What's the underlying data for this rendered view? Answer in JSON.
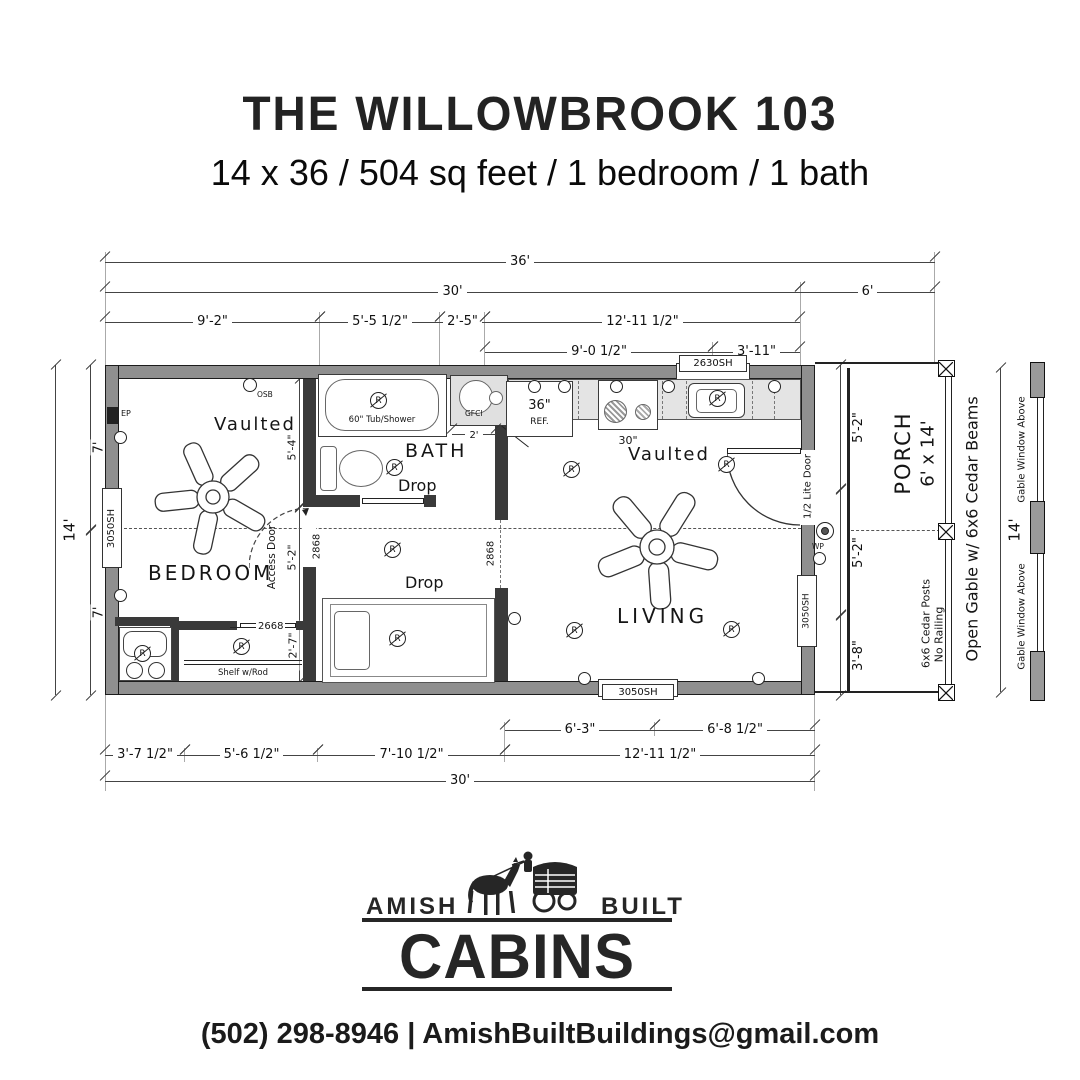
{
  "header": {
    "title": "THE WILLOWBROOK 103",
    "subtitle": "14 x 36 / 504 sq feet / 1 bedroom / 1 bath"
  },
  "rooms": {
    "bedroom": "BEDROOM",
    "bath": "BATH",
    "living": "LIVING",
    "porch": "PORCH",
    "porch_size": "6' x 14'",
    "vaulted_bedroom": "Vaulted",
    "vaulted_living": "Vaulted",
    "drop_bath": "Drop",
    "drop_hall": "Drop"
  },
  "fixtures": {
    "tub": "60\" Tub/Shower",
    "fridge_width": "36\"",
    "fridge": "REF.",
    "range_width": "30\"",
    "gfci": "GFCI",
    "shelf": "Shelf w/Rod",
    "receptacle": "R"
  },
  "notes": {
    "access_door": "Access Door",
    "half_lite_door": "1/2 Lite Door",
    "ep": "EP",
    "osb": "OSB",
    "wp": "WP",
    "posts": "6x6 Cedar Posts",
    "no_railing": "No Railing",
    "open_gable": "Open Gable w/ 6x6 Cedar Beams",
    "gable_window_top": "Gable Window Above",
    "gable_window_bottom": "Gable Window Above"
  },
  "windows": {
    "left": "3050SH",
    "right": "3050SH",
    "bottom": "3050SH",
    "kitchen": "2630SH"
  },
  "doors": {
    "access": "2868",
    "bath": "2868",
    "hall": "2868",
    "closet": "2668"
  },
  "dims": {
    "t36": "36'",
    "t30": "30'",
    "t6": "6'",
    "t92": "9'-2\"",
    "t55": "5'-5 1/2\"",
    "t25": "2'-5\"",
    "t1211": "12'-11 1/2\"",
    "t90": "9'-0 1/2\"",
    "t311": "3'-11\"",
    "b63": "6'-3\"",
    "b68": "6'-8 1/2\"",
    "b37": "3'-7 1/2\"",
    "b56": "5'-6 1/2\"",
    "b710": "7'-10 1/2\"",
    "b1211": "12'-11 1/2\"",
    "b30": "30'",
    "l14": "14'",
    "l7a": "7'",
    "l7b": "7'",
    "r52a": "5'-2\"",
    "r52b": "5'-2\"",
    "r38": "3'-8\"",
    "i54": "5'-4\"",
    "i52": "5'-2\"",
    "i27": "2'-7\"",
    "v2": "2'",
    "p14": "14'"
  },
  "colors": {
    "wall_fill": "#8f8f8f",
    "counter_fill": "#e4e4e4",
    "line": "#222222"
  },
  "footer": {
    "amish": "AMISH",
    "built": "BUILT",
    "cabins": "CABINS",
    "contact": "(502) 298-8946 | AmishBuiltBuildings@gmail.com"
  }
}
